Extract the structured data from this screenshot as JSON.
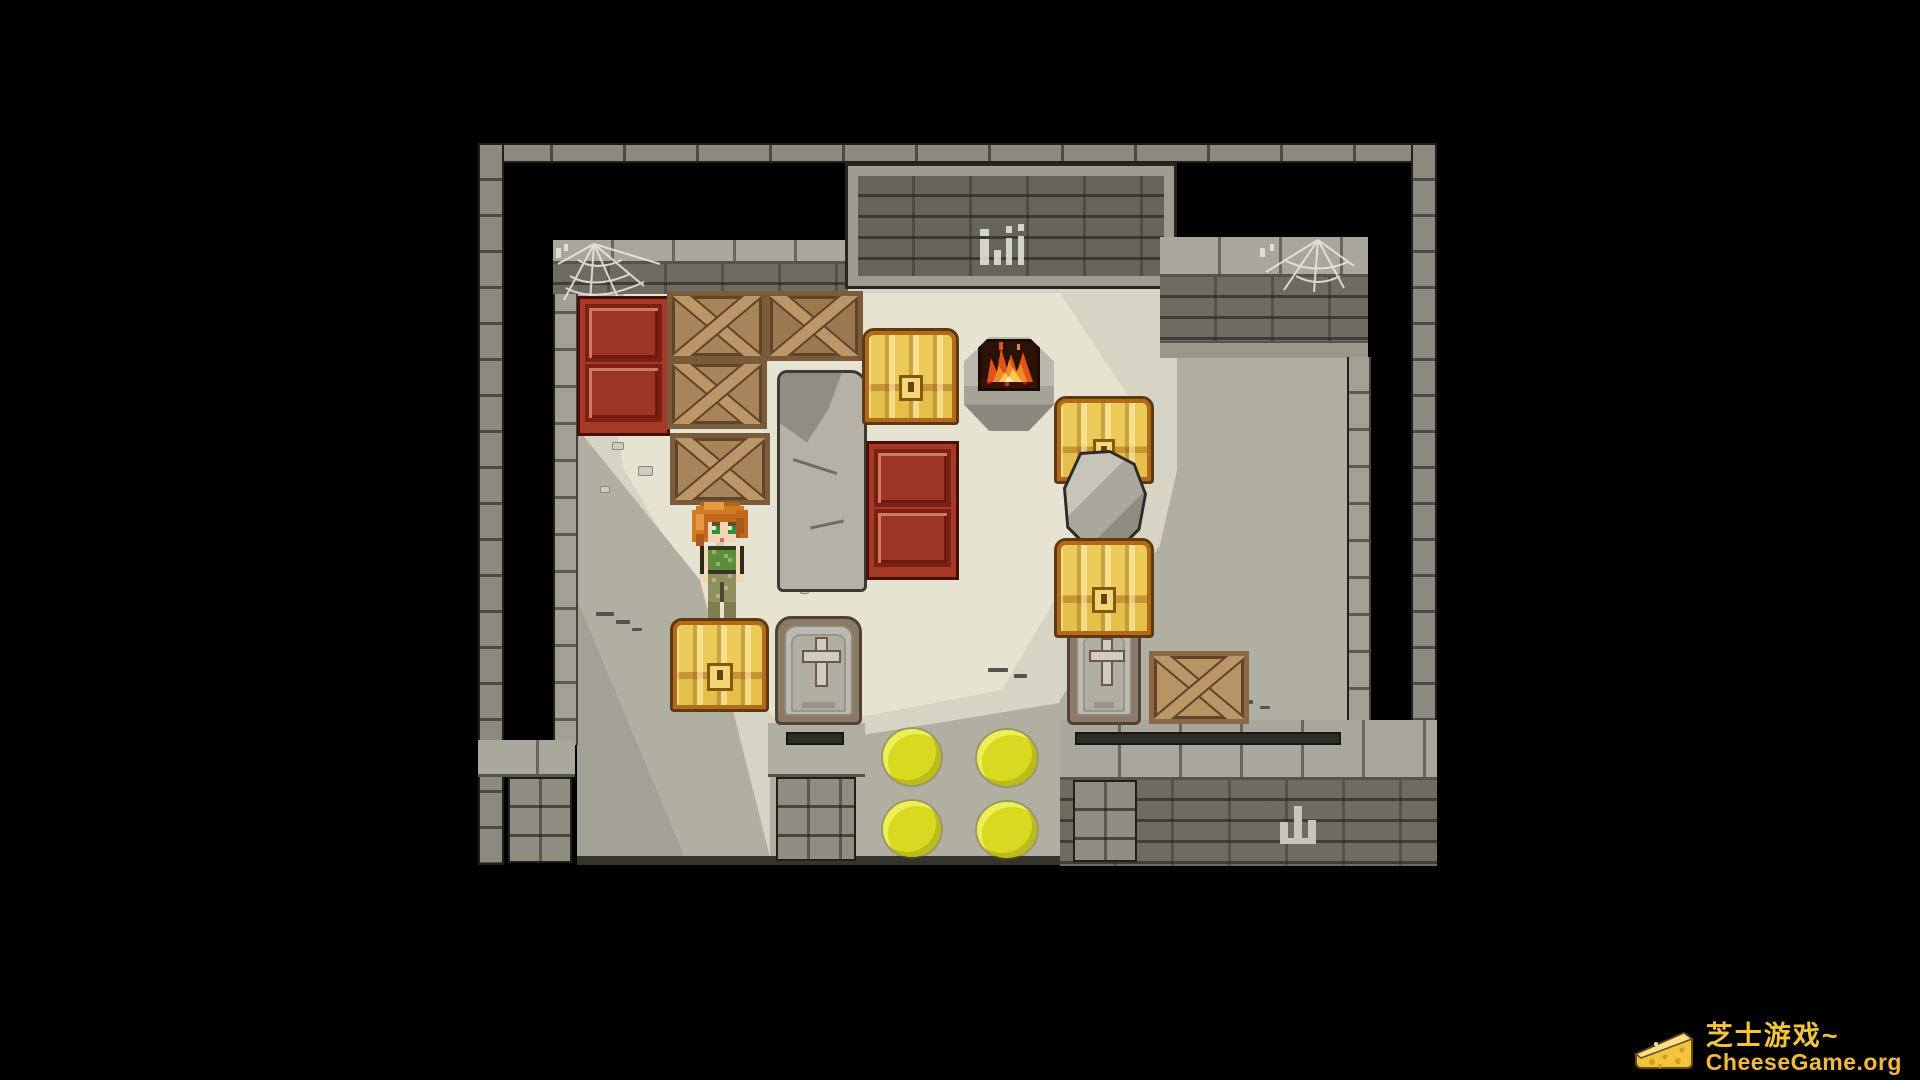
{
  "window": {
    "width": 1920,
    "height": 1080,
    "background": "#000000",
    "type": "pixel-art game screenshot"
  },
  "watermark": {
    "icon": "cheese-wedge-icon",
    "brand": "芝士游戏~",
    "site": "CheeseGame.org",
    "brand_color": "#f2c53d",
    "site_color": "#f2b93d"
  },
  "game": {
    "style": "top-down pixel-art dungeon storeroom",
    "palette": {
      "wall": "#8c897f",
      "wall_cap": "#a9a69b",
      "wall_face": "#6e6c62",
      "floor": "#d8d4c5",
      "floor_light": "#e7e3d3",
      "floor_shadow": "#b1aea2",
      "crate_red": "#a63a28",
      "crate_wood": "#a8845a",
      "chest_gold": "#e4bf4a",
      "chest_trim": "#b06a1a",
      "fire_orange": "#f08c28",
      "plate_yellow": "#d9d922",
      "stone": "#b4b1a6",
      "web": "#eceae4"
    },
    "player": {
      "name": "player-character",
      "hair_color": "#d07a26",
      "eye_color": "#2f9135",
      "top_color": "#5c8c3c",
      "pants_color": "#90905e",
      "facing": "down",
      "position": "left-center of room, standing behind a gold chest"
    },
    "objects": [
      {
        "name": "red-crate-stack-left",
        "count": 2
      },
      {
        "name": "wooden-x-crate-group-top-left",
        "count": 4
      },
      {
        "name": "stone-slab",
        "count": 1
      },
      {
        "name": "gold-chest",
        "count": 4
      },
      {
        "name": "fire-brazier",
        "count": 1,
        "lit": true
      },
      {
        "name": "red-crate-stack-center",
        "count": 2
      },
      {
        "name": "red-crate-stack-right",
        "count": 4
      },
      {
        "name": "boulder",
        "count": 1
      },
      {
        "name": "coffin-with-cross",
        "count": 2
      },
      {
        "name": "wooden-x-crate-single",
        "count": 1
      },
      {
        "name": "pressure-plate-yellow",
        "count": 4
      },
      {
        "name": "spider-web",
        "count": 2
      },
      {
        "name": "wall-graffiti",
        "marks": [
          "white Pii-like scratches on top wall",
          "mountain-shaped pale mark on bottom wall"
        ]
      }
    ]
  }
}
